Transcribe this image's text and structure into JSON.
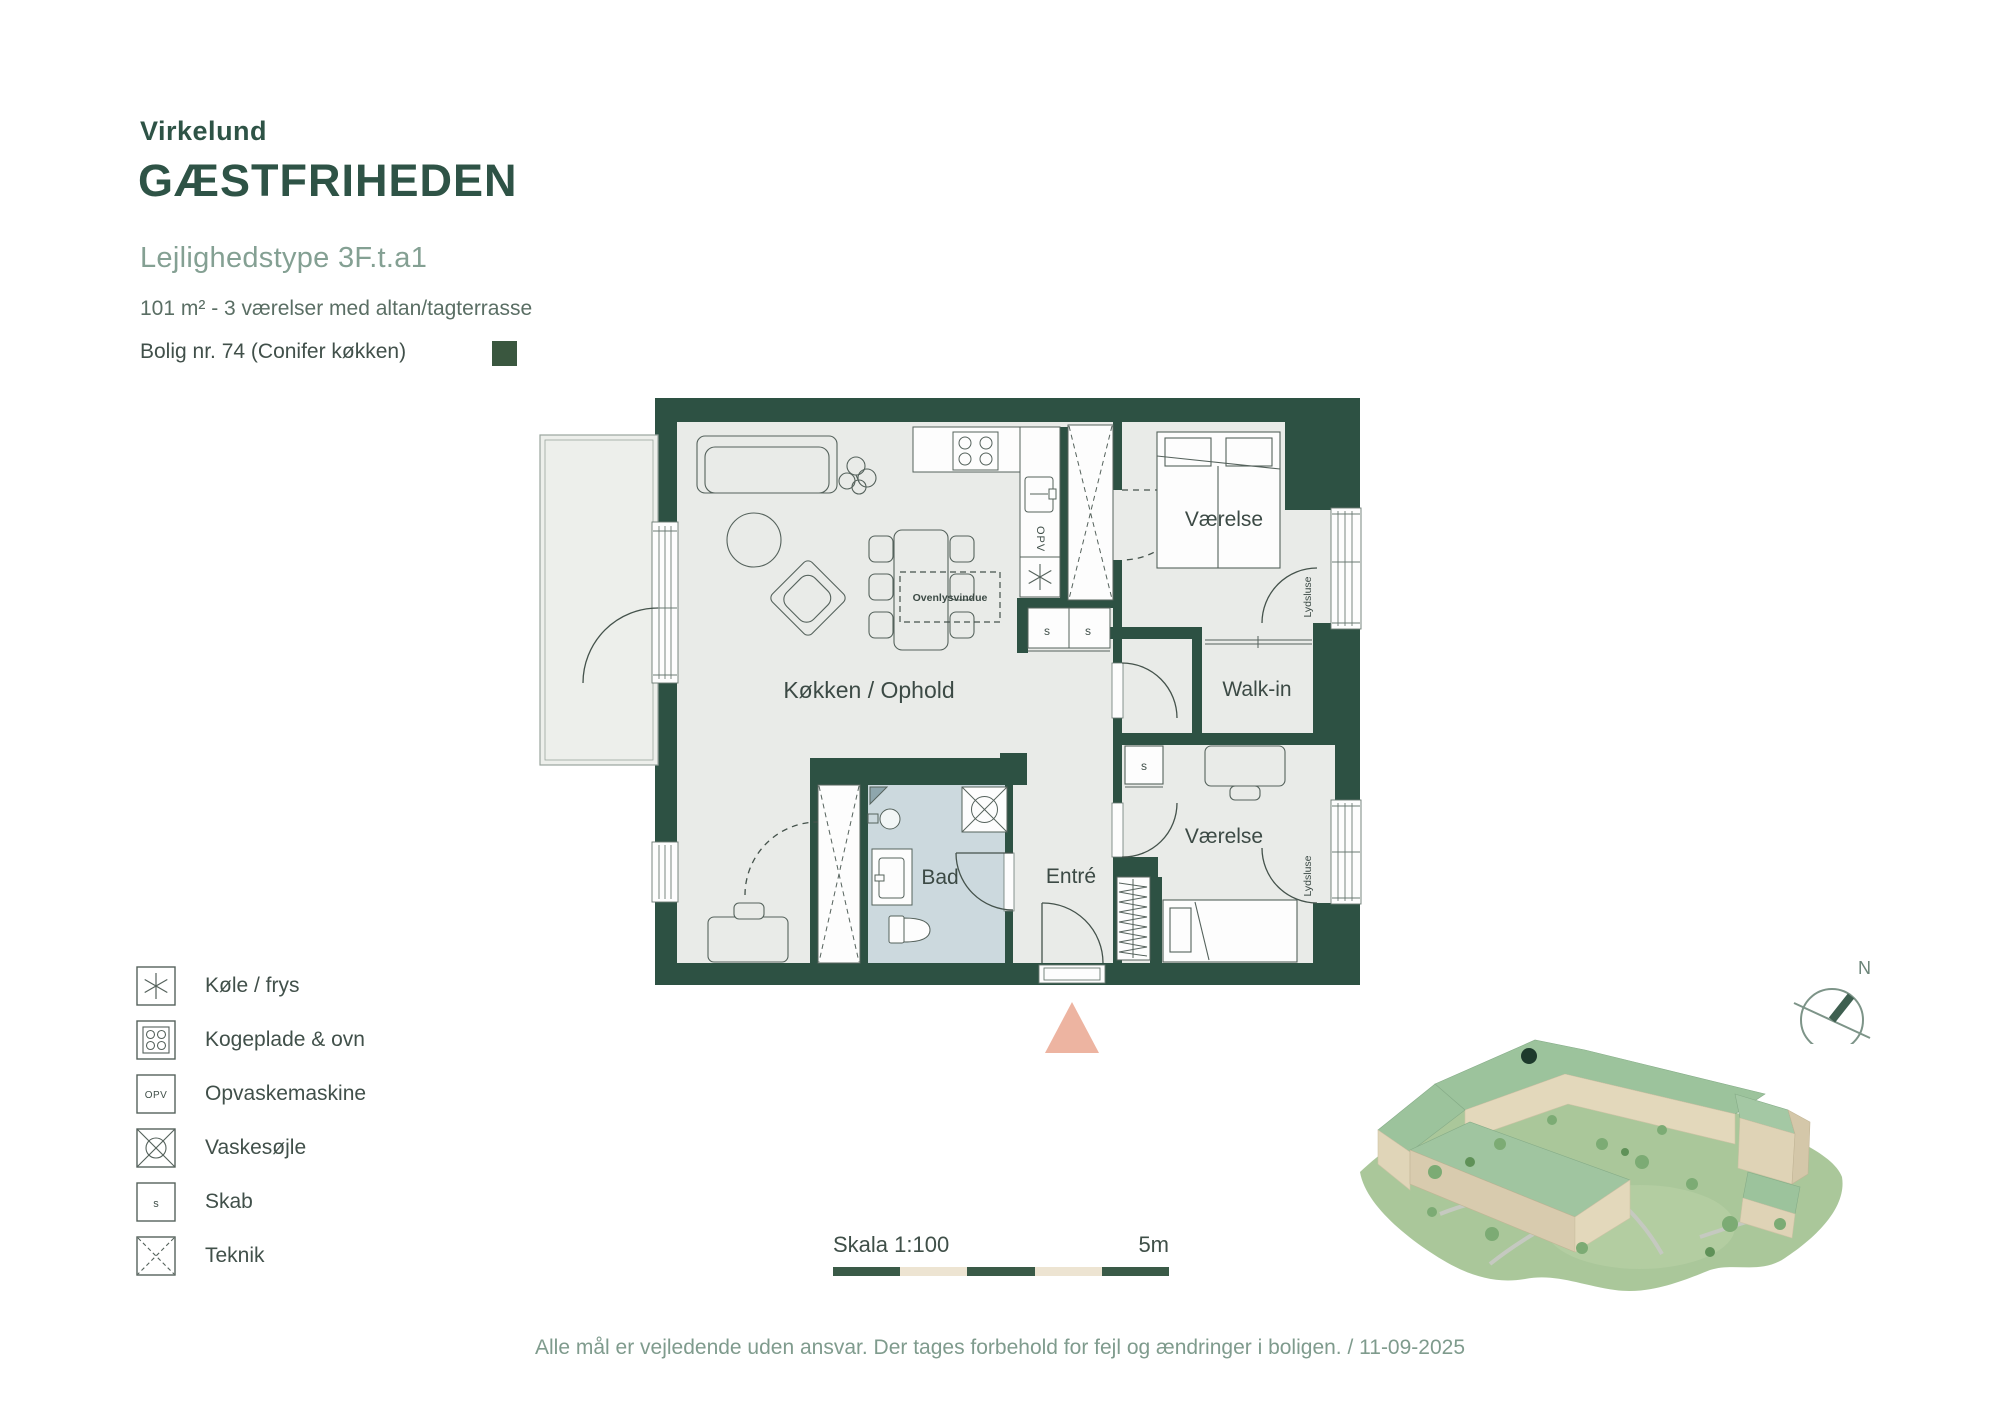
{
  "header": {
    "brand": "Virkelund",
    "project": "GÆSTFRIHEDEN",
    "apartment_type": "Lejlighedstype 3F.t.a1",
    "details": "101 m² - 3 værelser med altan/tagterrasse",
    "unit": "Bolig nr. 74 (Conifer køkken)"
  },
  "plan": {
    "rooms": {
      "living": "Køkken / Ophold",
      "bedroom1": "Værelse",
      "bedroom2": "Værelse",
      "walkin": "Walk-in",
      "bath": "Bad",
      "entry": "Entré"
    },
    "annotations": {
      "skylight": "Ovenlysvindue",
      "soundlock": "Lydsluse",
      "dishwasher": "OPV",
      "cabinet": "s"
    }
  },
  "legend": {
    "items": [
      {
        "icon": "fridge-freezer-icon",
        "label": "Køle / frys"
      },
      {
        "icon": "hob-oven-icon",
        "label": "Kogeplade & ovn"
      },
      {
        "icon": "dishwasher-icon",
        "label": "Opvaskemaskine",
        "abbr": "OPV"
      },
      {
        "icon": "washer-column-icon",
        "label": "Vaskesøjle"
      },
      {
        "icon": "cabinet-icon",
        "label": "Skab",
        "abbr": "s"
      },
      {
        "icon": "technical-icon",
        "label": "Teknik"
      }
    ]
  },
  "scalebar": {
    "label": "Skala 1:100",
    "distance": "5m"
  },
  "compass": {
    "north_label": "N"
  },
  "footer": {
    "disclaimer": "Alle mål er vejledende uden ansvar. Der tages forbehold for fejl og ændringer i boligen. / 11-09-2025"
  },
  "colors": {
    "wall_green": "#2d5143",
    "accent_square": "#3a573f",
    "bath_floor": "#ccd9de",
    "entrance_marker": "#edb4a1",
    "scalebar_green": "#3a5a47",
    "scalebar_cream": "#ede4d2",
    "muted_green_text": "#7f9b8d"
  }
}
